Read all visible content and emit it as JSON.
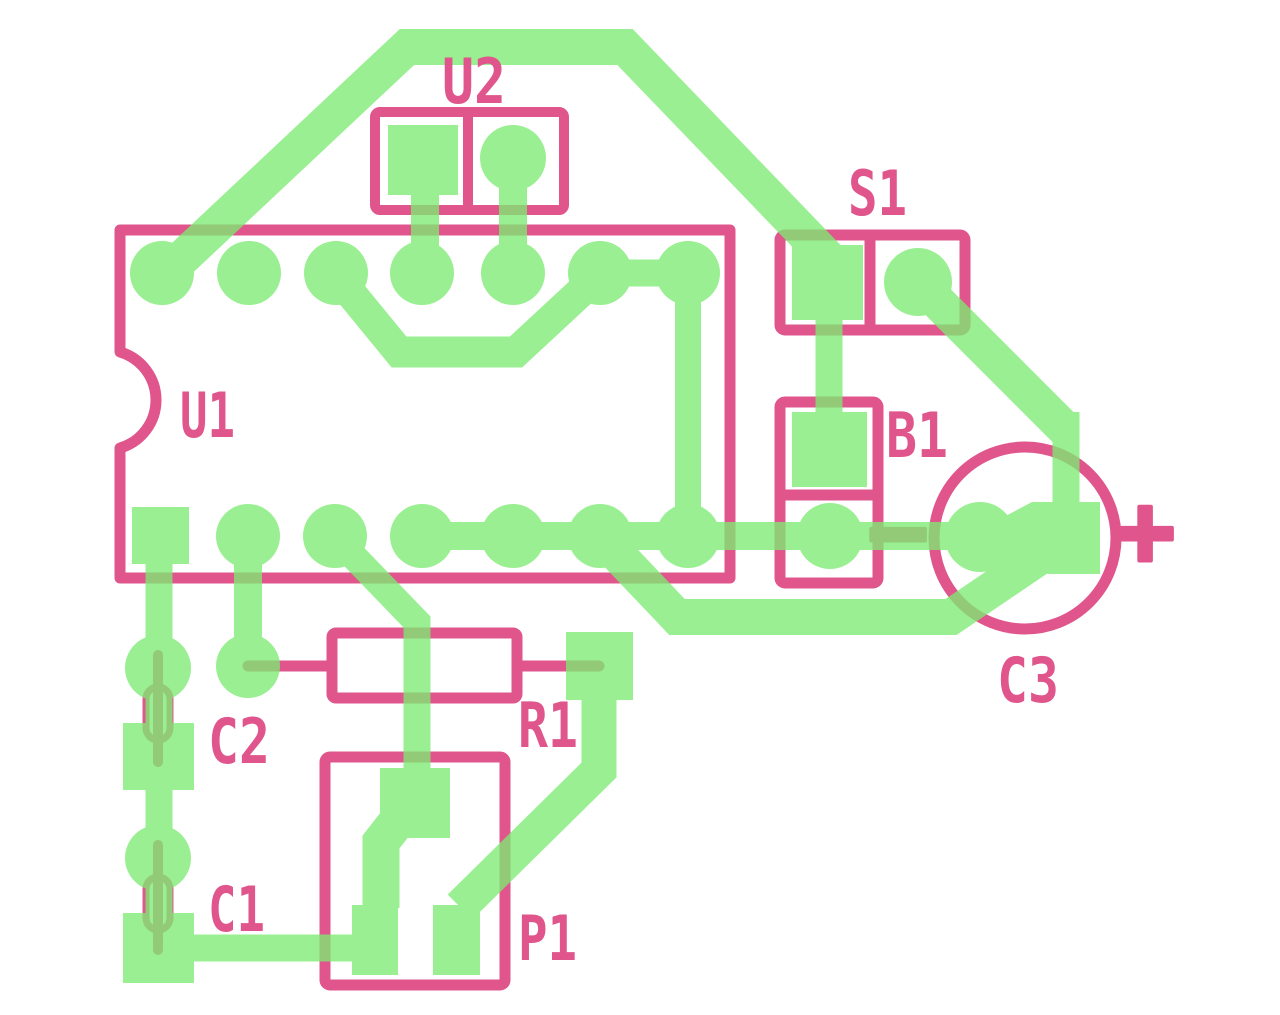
{
  "diagram": {
    "type": "pcb-layout",
    "colors": {
      "background": "#FFFFFF",
      "silkscreen": "#DF558C",
      "copper": "#7DEB73",
      "copper_opacity": "0.78"
    },
    "components": {
      "u1": {
        "label": "U1"
      },
      "u2": {
        "label": "U2"
      },
      "s1": {
        "label": "S1"
      },
      "b1": {
        "label": "B1"
      },
      "c1": {
        "label": "C1"
      },
      "c2": {
        "label": "C2"
      },
      "c3": {
        "label": "C3"
      },
      "r1": {
        "label": "R1"
      },
      "p1": {
        "label": "P1"
      }
    },
    "marks": {
      "plus": "+",
      "minus": "−"
    }
  }
}
